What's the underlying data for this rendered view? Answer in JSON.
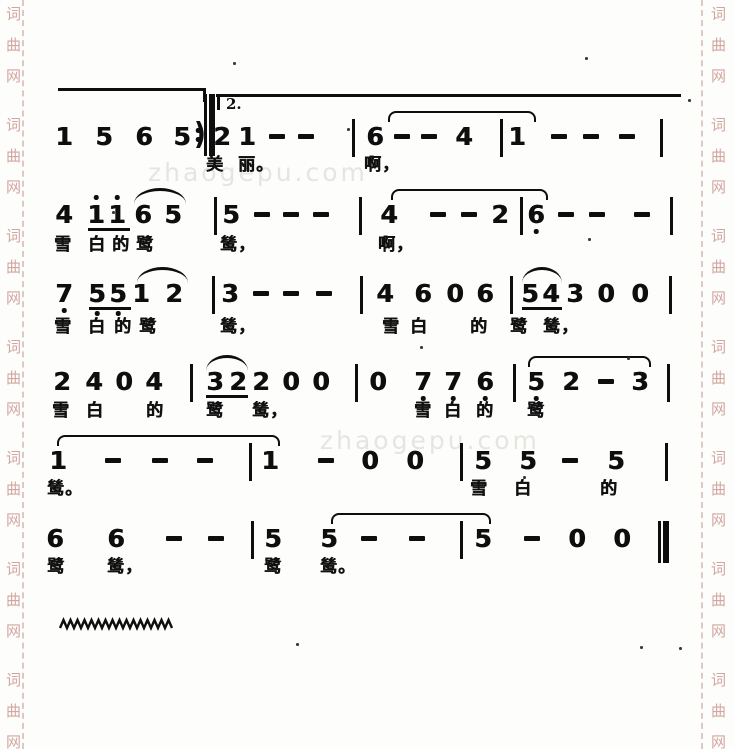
{
  "page": {
    "width": 735,
    "height": 749,
    "background": "#fdfdfb",
    "ink": "#0e0e0e"
  },
  "watermarks": {
    "side": {
      "chars": [
        "词",
        "曲",
        "网"
      ],
      "color": "#d2a6a0",
      "start_y": 6,
      "char_spacing": 31,
      "group_period": 111,
      "groups": 7,
      "left_x": 6,
      "right_x": 711
    },
    "side_lines": {
      "left_x": 22,
      "right_x": 701
    },
    "center": {
      "text": "zhaogepu.com",
      "color": "#e7e5e2",
      "instances": [
        {
          "x": 148,
          "y": 158
        },
        {
          "x": 320,
          "y": 426
        }
      ]
    }
  },
  "volta": {
    "label": "2.",
    "pre_line": {
      "x1": 58,
      "x2": 205,
      "y": 88
    },
    "main_line": {
      "x1": 216,
      "x2": 681,
      "y": 94
    },
    "tick_x": 217,
    "label_x": 226,
    "label_y": 95
  },
  "wavy": {
    "x": 60,
    "y": 618,
    "width": 114,
    "amp": 8,
    "step": 7
  },
  "specks": [
    [
      233,
      62
    ],
    [
      585,
      57
    ],
    [
      688,
      99
    ],
    [
      347,
      128
    ],
    [
      112,
      211
    ],
    [
      588,
      238
    ],
    [
      420,
      346
    ],
    [
      627,
      357
    ],
    [
      523,
      476
    ],
    [
      296,
      643
    ],
    [
      640,
      646
    ],
    [
      679,
      647
    ]
  ],
  "score": {
    "systems": [
      {
        "y": 124,
        "lyrics_y": 156,
        "notes": [
          {
            "g": "1",
            "x": 64
          },
          {
            "g": "5",
            "x": 104
          },
          {
            "g": "6",
            "x": 144
          },
          {
            "g": "5",
            "x": 182
          },
          {
            "g": ")",
            "x": 200,
            "paren": true
          },
          {
            "bar": "repeat",
            "x": 207
          },
          {
            "g": "2",
            "x": 222
          },
          {
            "g": "1",
            "x": 247
          },
          {
            "g": "-",
            "x": 277
          },
          {
            "g": "-",
            "x": 306
          },
          {
            "bar": "single",
            "x": 353
          },
          {
            "g": "6",
            "x": 375
          },
          {
            "g": "-",
            "x": 402
          },
          {
            "g": "-",
            "x": 429
          },
          {
            "g": "4",
            "x": 464
          },
          {
            "bar": "single",
            "x": 501
          },
          {
            "g": "1",
            "x": 517
          },
          {
            "g": "-",
            "x": 559
          },
          {
            "g": "-",
            "x": 591
          },
          {
            "g": "-",
            "x": 627
          },
          {
            "bar": "single",
            "x": 661
          }
        ],
        "beams": [],
        "arcs": [],
        "ties": [
          {
            "x1": 388,
            "x2": 537
          }
        ],
        "lyrics": [
          {
            "t": "美",
            "x": 206
          },
          {
            "t": "丽。",
            "x": 238
          },
          {
            "t": "啊，",
            "x": 364
          }
        ]
      },
      {
        "y": 202,
        "lyrics_y": 236,
        "notes": [
          {
            "g": "4",
            "x": 64
          },
          {
            "g": "1",
            "x": 96,
            "da": 1,
            "u": 1
          },
          {
            "g": "1",
            "x": 117,
            "da": 1,
            "u": 1
          },
          {
            "g": "6",
            "x": 143
          },
          {
            "g": "5",
            "x": 173
          },
          {
            "bar": "single",
            "x": 215
          },
          {
            "g": "5",
            "x": 231
          },
          {
            "g": "-",
            "x": 262
          },
          {
            "g": "-",
            "x": 291
          },
          {
            "g": "-",
            "x": 321
          },
          {
            "bar": "single",
            "x": 360
          },
          {
            "g": "4",
            "x": 389
          },
          {
            "g": "-",
            "x": 438
          },
          {
            "g": "-",
            "x": 469
          },
          {
            "g": "2",
            "x": 500
          },
          {
            "bar": "single",
            "x": 521
          },
          {
            "g": "6",
            "x": 536,
            "db": 1
          },
          {
            "g": "-",
            "x": 566
          },
          {
            "g": "-",
            "x": 597
          },
          {
            "g": "-",
            "x": 642
          },
          {
            "bar": "single",
            "x": 671
          }
        ],
        "beams": [
          {
            "x1": 88,
            "x2": 130
          }
        ],
        "arcs": [
          {
            "x1": 134,
            "x2": 186
          }
        ],
        "ties": [
          {
            "x1": 391,
            "x2": 549
          }
        ],
        "lyrics": [
          {
            "t": "雪",
            "x": 54
          },
          {
            "t": "白",
            "x": 88
          },
          {
            "t": "的",
            "x": 112
          },
          {
            "t": "鹭",
            "x": 136
          },
          {
            "t": "鸶，",
            "x": 220
          },
          {
            "t": "啊，",
            "x": 378
          }
        ]
      },
      {
        "y": 281,
        "lyrics_y": 318,
        "notes": [
          {
            "g": "7",
            "x": 64,
            "db": 1
          },
          {
            "g": "5",
            "x": 97,
            "db": 1,
            "u": 1
          },
          {
            "g": "5",
            "x": 118,
            "db": 1,
            "u": 1
          },
          {
            "g": "1",
            "x": 141
          },
          {
            "g": "2",
            "x": 174
          },
          {
            "bar": "single",
            "x": 213
          },
          {
            "g": "3",
            "x": 230
          },
          {
            "g": "-",
            "x": 261
          },
          {
            "g": "-",
            "x": 291
          },
          {
            "g": "-",
            "x": 324
          },
          {
            "bar": "single",
            "x": 361
          },
          {
            "g": "4",
            "x": 385
          },
          {
            "g": "6",
            "x": 423
          },
          {
            "g": "0",
            "x": 455
          },
          {
            "g": "6",
            "x": 485
          },
          {
            "bar": "single",
            "x": 511
          },
          {
            "g": "5",
            "x": 530,
            "u": 1
          },
          {
            "g": "4",
            "x": 551,
            "u": 1
          },
          {
            "g": "3",
            "x": 575
          },
          {
            "g": "0",
            "x": 606
          },
          {
            "g": "0",
            "x": 640
          },
          {
            "bar": "single",
            "x": 670
          }
        ],
        "beams": [
          {
            "x1": 89,
            "x2": 131
          },
          {
            "x1": 522,
            "x2": 562
          }
        ],
        "arcs": [
          {
            "x1": 137,
            "x2": 188
          },
          {
            "x1": 522,
            "x2": 562
          }
        ],
        "ties": [],
        "lyrics": [
          {
            "t": "雪",
            "x": 54
          },
          {
            "t": "白",
            "x": 88
          },
          {
            "t": "的",
            "x": 114
          },
          {
            "t": "鹭",
            "x": 139
          },
          {
            "t": "鸶，",
            "x": 220
          },
          {
            "t": "雪",
            "x": 382
          },
          {
            "t": "白",
            "x": 410
          },
          {
            "t": "的",
            "x": 470
          },
          {
            "t": "鹭",
            "x": 510
          },
          {
            "t": "鸶，",
            "x": 543
          }
        ]
      },
      {
        "y": 369,
        "lyrics_y": 402,
        "notes": [
          {
            "g": "2",
            "x": 62
          },
          {
            "g": "4",
            "x": 94
          },
          {
            "g": "0",
            "x": 124
          },
          {
            "g": "4",
            "x": 154
          },
          {
            "bar": "single",
            "x": 191
          },
          {
            "g": "3",
            "x": 215,
            "u": 1
          },
          {
            "g": "2",
            "x": 238,
            "u": 1
          },
          {
            "g": "2",
            "x": 261
          },
          {
            "g": "0",
            "x": 291
          },
          {
            "g": "0",
            "x": 321
          },
          {
            "bar": "single",
            "x": 356
          },
          {
            "g": "0",
            "x": 378
          },
          {
            "g": "7",
            "x": 423,
            "db": 1
          },
          {
            "g": "7",
            "x": 453,
            "db": 1
          },
          {
            "g": "6",
            "x": 485,
            "db": 1
          },
          {
            "bar": "single",
            "x": 514
          },
          {
            "g": "5",
            "x": 536,
            "db": 1
          },
          {
            "g": "2",
            "x": 571
          },
          {
            "g": "-",
            "x": 606
          },
          {
            "g": "3",
            "x": 640
          },
          {
            "bar": "single",
            "x": 668
          }
        ],
        "beams": [
          {
            "x1": 206,
            "x2": 248
          }
        ],
        "arcs": [
          {
            "x1": 206,
            "x2": 248
          }
        ],
        "ties": [
          {
            "x1": 528,
            "x2": 652
          }
        ],
        "lyrics": [
          {
            "t": "雪",
            "x": 52
          },
          {
            "t": "白",
            "x": 86
          },
          {
            "t": "的",
            "x": 146
          },
          {
            "t": "鹭",
            "x": 206
          },
          {
            "t": "鸶，",
            "x": 252
          },
          {
            "t": "雪",
            "x": 414
          },
          {
            "t": "白",
            "x": 444
          },
          {
            "t": "的",
            "x": 476
          },
          {
            "t": "鹭",
            "x": 527
          }
        ]
      },
      {
        "y": 448,
        "lyrics_y": 480,
        "notes": [
          {
            "g": "1",
            "x": 58
          },
          {
            "g": "-",
            "x": 113
          },
          {
            "g": "-",
            "x": 160
          },
          {
            "g": "-",
            "x": 205
          },
          {
            "bar": "single",
            "x": 250
          },
          {
            "g": "1",
            "x": 270
          },
          {
            "g": "-",
            "x": 326
          },
          {
            "g": "0",
            "x": 370
          },
          {
            "g": "0",
            "x": 415
          },
          {
            "bar": "single",
            "x": 461
          },
          {
            "g": "5",
            "x": 483
          },
          {
            "g": "5",
            "x": 528
          },
          {
            "g": "-",
            "x": 570
          },
          {
            "g": "5",
            "x": 616
          },
          {
            "bar": "single",
            "x": 666
          }
        ],
        "beams": [],
        "arcs": [],
        "ties": [
          {
            "x1": 57,
            "x2": 281
          }
        ],
        "lyrics": [
          {
            "t": "鸶。",
            "x": 47
          },
          {
            "t": "雪",
            "x": 470
          },
          {
            "t": "白",
            "x": 514
          },
          {
            "t": "的",
            "x": 600
          }
        ]
      },
      {
        "y": 526,
        "lyrics_y": 558,
        "notes": [
          {
            "g": "6",
            "x": 55
          },
          {
            "g": "6",
            "x": 116
          },
          {
            "g": "-",
            "x": 174
          },
          {
            "g": "-",
            "x": 216
          },
          {
            "bar": "single",
            "x": 252
          },
          {
            "g": "5",
            "x": 273
          },
          {
            "g": "5",
            "x": 329
          },
          {
            "g": "-",
            "x": 369
          },
          {
            "g": "-",
            "x": 417
          },
          {
            "bar": "single",
            "x": 461
          },
          {
            "g": "5",
            "x": 483
          },
          {
            "g": "-",
            "x": 532
          },
          {
            "g": "0",
            "x": 577
          },
          {
            "g": "0",
            "x": 622
          },
          {
            "bar": "final",
            "x": 658
          }
        ],
        "beams": [],
        "arcs": [],
        "ties": [
          {
            "x1": 331,
            "x2": 492
          }
        ],
        "lyrics": [
          {
            "t": "鹭",
            "x": 47
          },
          {
            "t": "鸶，",
            "x": 107
          },
          {
            "t": "鹭",
            "x": 264
          },
          {
            "t": "鸶。",
            "x": 320
          }
        ]
      }
    ]
  }
}
